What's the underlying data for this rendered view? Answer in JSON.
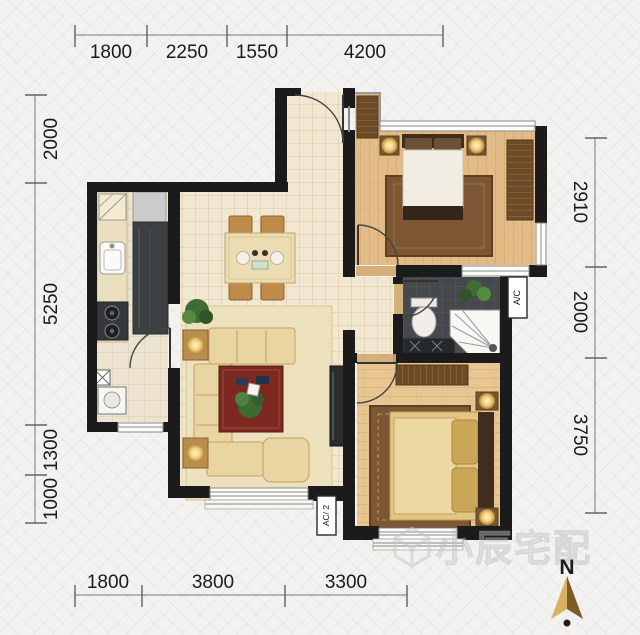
{
  "dims": {
    "top": [
      "1800",
      "2250",
      "1550",
      "4200"
    ],
    "bottom": [
      "1800",
      "3800",
      "3300"
    ],
    "left": [
      "2000",
      "5250",
      "1300",
      "1000"
    ],
    "right": [
      "2910",
      "2000",
      "3750"
    ]
  },
  "labels": {
    "ac_unit_living": "AC/ 2",
    "ac_unit_bath": "A/C",
    "compass_north": "N",
    "watermark": "小辰宅配"
  },
  "colors": {
    "wall": "#1b1b1b",
    "tile_floor": "#f2e8d2",
    "wood_floor_bedroom2": "#e2bb86",
    "wood_floor_master": "#e7c691",
    "bath_floor": "#45494c",
    "coffee_table_red": "#7c2a21",
    "compass_gold": "#d8b263"
  }
}
